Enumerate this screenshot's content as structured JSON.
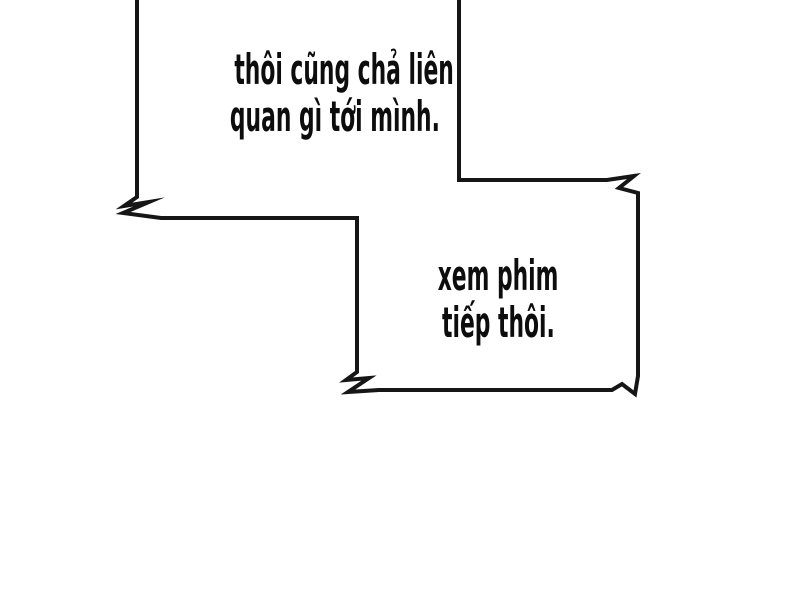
{
  "theme": {
    "paper": "#ffffff",
    "ink": "#161616",
    "text": "#0d0d0d"
  },
  "panel": {
    "type": "comic-page-segment"
  },
  "bubbles": [
    {
      "name": "speech-bubble-1",
      "shape": "rectangular-jagged",
      "lines": [
        "thôi cũng chả liên",
        "quan gì tới mình."
      ]
    },
    {
      "name": "speech-bubble-2",
      "shape": "rectangular-jagged",
      "lines": [
        "xem phim",
        "tiếp thôi."
      ]
    }
  ]
}
